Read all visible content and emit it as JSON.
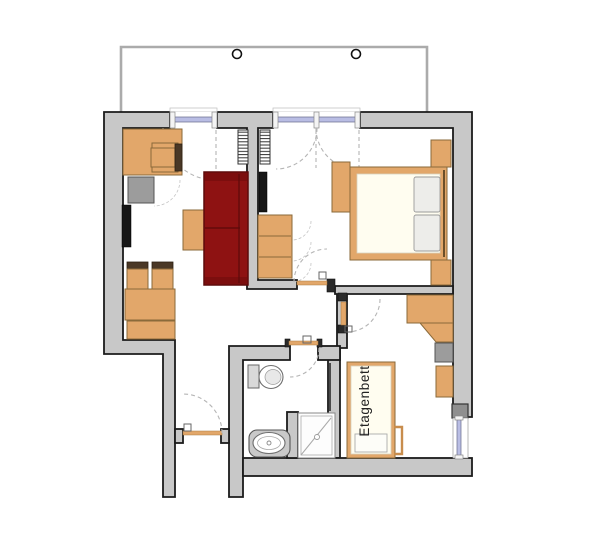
{
  "labels": {
    "bunk_bed": "Etagenbett"
  },
  "colors": {
    "wall-fill": "#c8c8c8",
    "wall-outline": "#1b1b1b",
    "furniture-wood": "#e2a76a",
    "furniture-wood-border": "#8a6a3a",
    "chair-back": "#4a3826",
    "sofa-red": "#8e1212",
    "sofa-red-dark": "#5c0a0a",
    "bed-linen": "#fffdf0",
    "appliance-gray": "#9c9c9c",
    "tv-black": "#161616",
    "window-glazing": "#b9bde4",
    "balcony-line": "#ababab",
    "door-arc": "#b5b5b5",
    "fixture-outline": "#6e6e6e",
    "text-color": "#222222"
  },
  "rooms": [
    {
      "name": "balcony",
      "features": [
        "railing",
        "post-left",
        "post-right"
      ]
    },
    {
      "name": "living-room",
      "furniture": [
        "desk",
        "desk-chair",
        "mini-fridge",
        "wall-tv",
        "coffee-table",
        "sofa",
        "dining-chair-1",
        "dining-chair-2",
        "dining-table",
        "sideboard",
        "radiator"
      ]
    },
    {
      "name": "bedroom",
      "furniture": [
        "double-bed",
        "pillow-left",
        "pillow-right",
        "nightstand-top",
        "nightstand-bottom",
        "wardrobe",
        "tv",
        "radiator"
      ]
    },
    {
      "name": "hall",
      "furniture": [
        "shelf-unit"
      ],
      "features": [
        "entry-door"
      ]
    },
    {
      "name": "bathroom",
      "fixtures": [
        "toilet",
        "washbasin",
        "shower"
      ]
    },
    {
      "name": "kids-room",
      "label_key": "bunk_bed",
      "furniture": [
        "bunk-bed",
        "ladder",
        "wardrobe",
        "corner-closet",
        "cabinet-gray",
        "cabinet-wood"
      ]
    }
  ],
  "doors": [
    "balcony-door-living",
    "balcony-door-bedroom",
    "entry-door",
    "bedroom-door",
    "bathroom-door",
    "kids-room-door"
  ],
  "windows": [
    "kids-room-window"
  ]
}
